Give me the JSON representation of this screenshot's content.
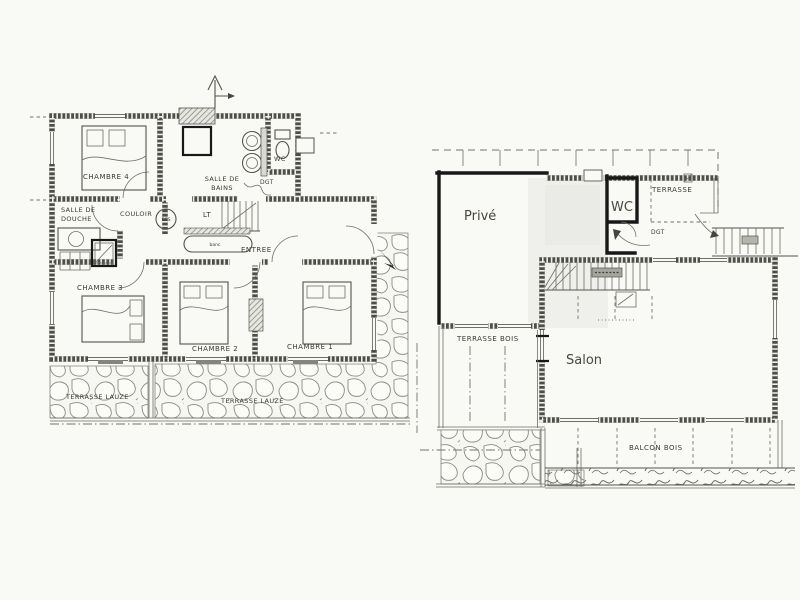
{
  "document": {
    "type": "scanned floor plan, two levels side by side",
    "colors": {
      "paper": "#f9f9f6",
      "ink": "#4e4e48",
      "bold_annotation": "#181818",
      "stone": "#8c8c84"
    }
  },
  "plan1": {
    "name": "ground floor (bedrooms level)",
    "labels": {
      "chambre4": "CHAMBRE 4",
      "salle_de_bains_1": "SALLE DE",
      "salle_de_bains_2": "BAINS",
      "wc": "WC",
      "dgt": "DGT",
      "douche_1": "SALLE DE",
      "douche_2": "DOUCHE",
      "couloir": "COULOIR",
      "lt": "LT",
      "ecs": "ECS",
      "banc": "banc",
      "entree": "ENTREE",
      "chambre3": "CHAMBRE 3",
      "chambre2": "CHAMBRE 2",
      "chambre1": "CHAMBRE 1",
      "terrasse_lauze_west": "TERRASSE LAUZE",
      "terrasse_lauze_south": "TERRASSE LAUZE"
    }
  },
  "plan2": {
    "name": "upper floor (living level)",
    "labels": {
      "prive": "Privé",
      "wc": "WC",
      "terrasse": "TERRASSE",
      "dgt": "DGT",
      "salon": "Salon",
      "terrasse_bois": "TERRASSE BOIS",
      "balcon_bois": "BALCON BOIS"
    }
  }
}
